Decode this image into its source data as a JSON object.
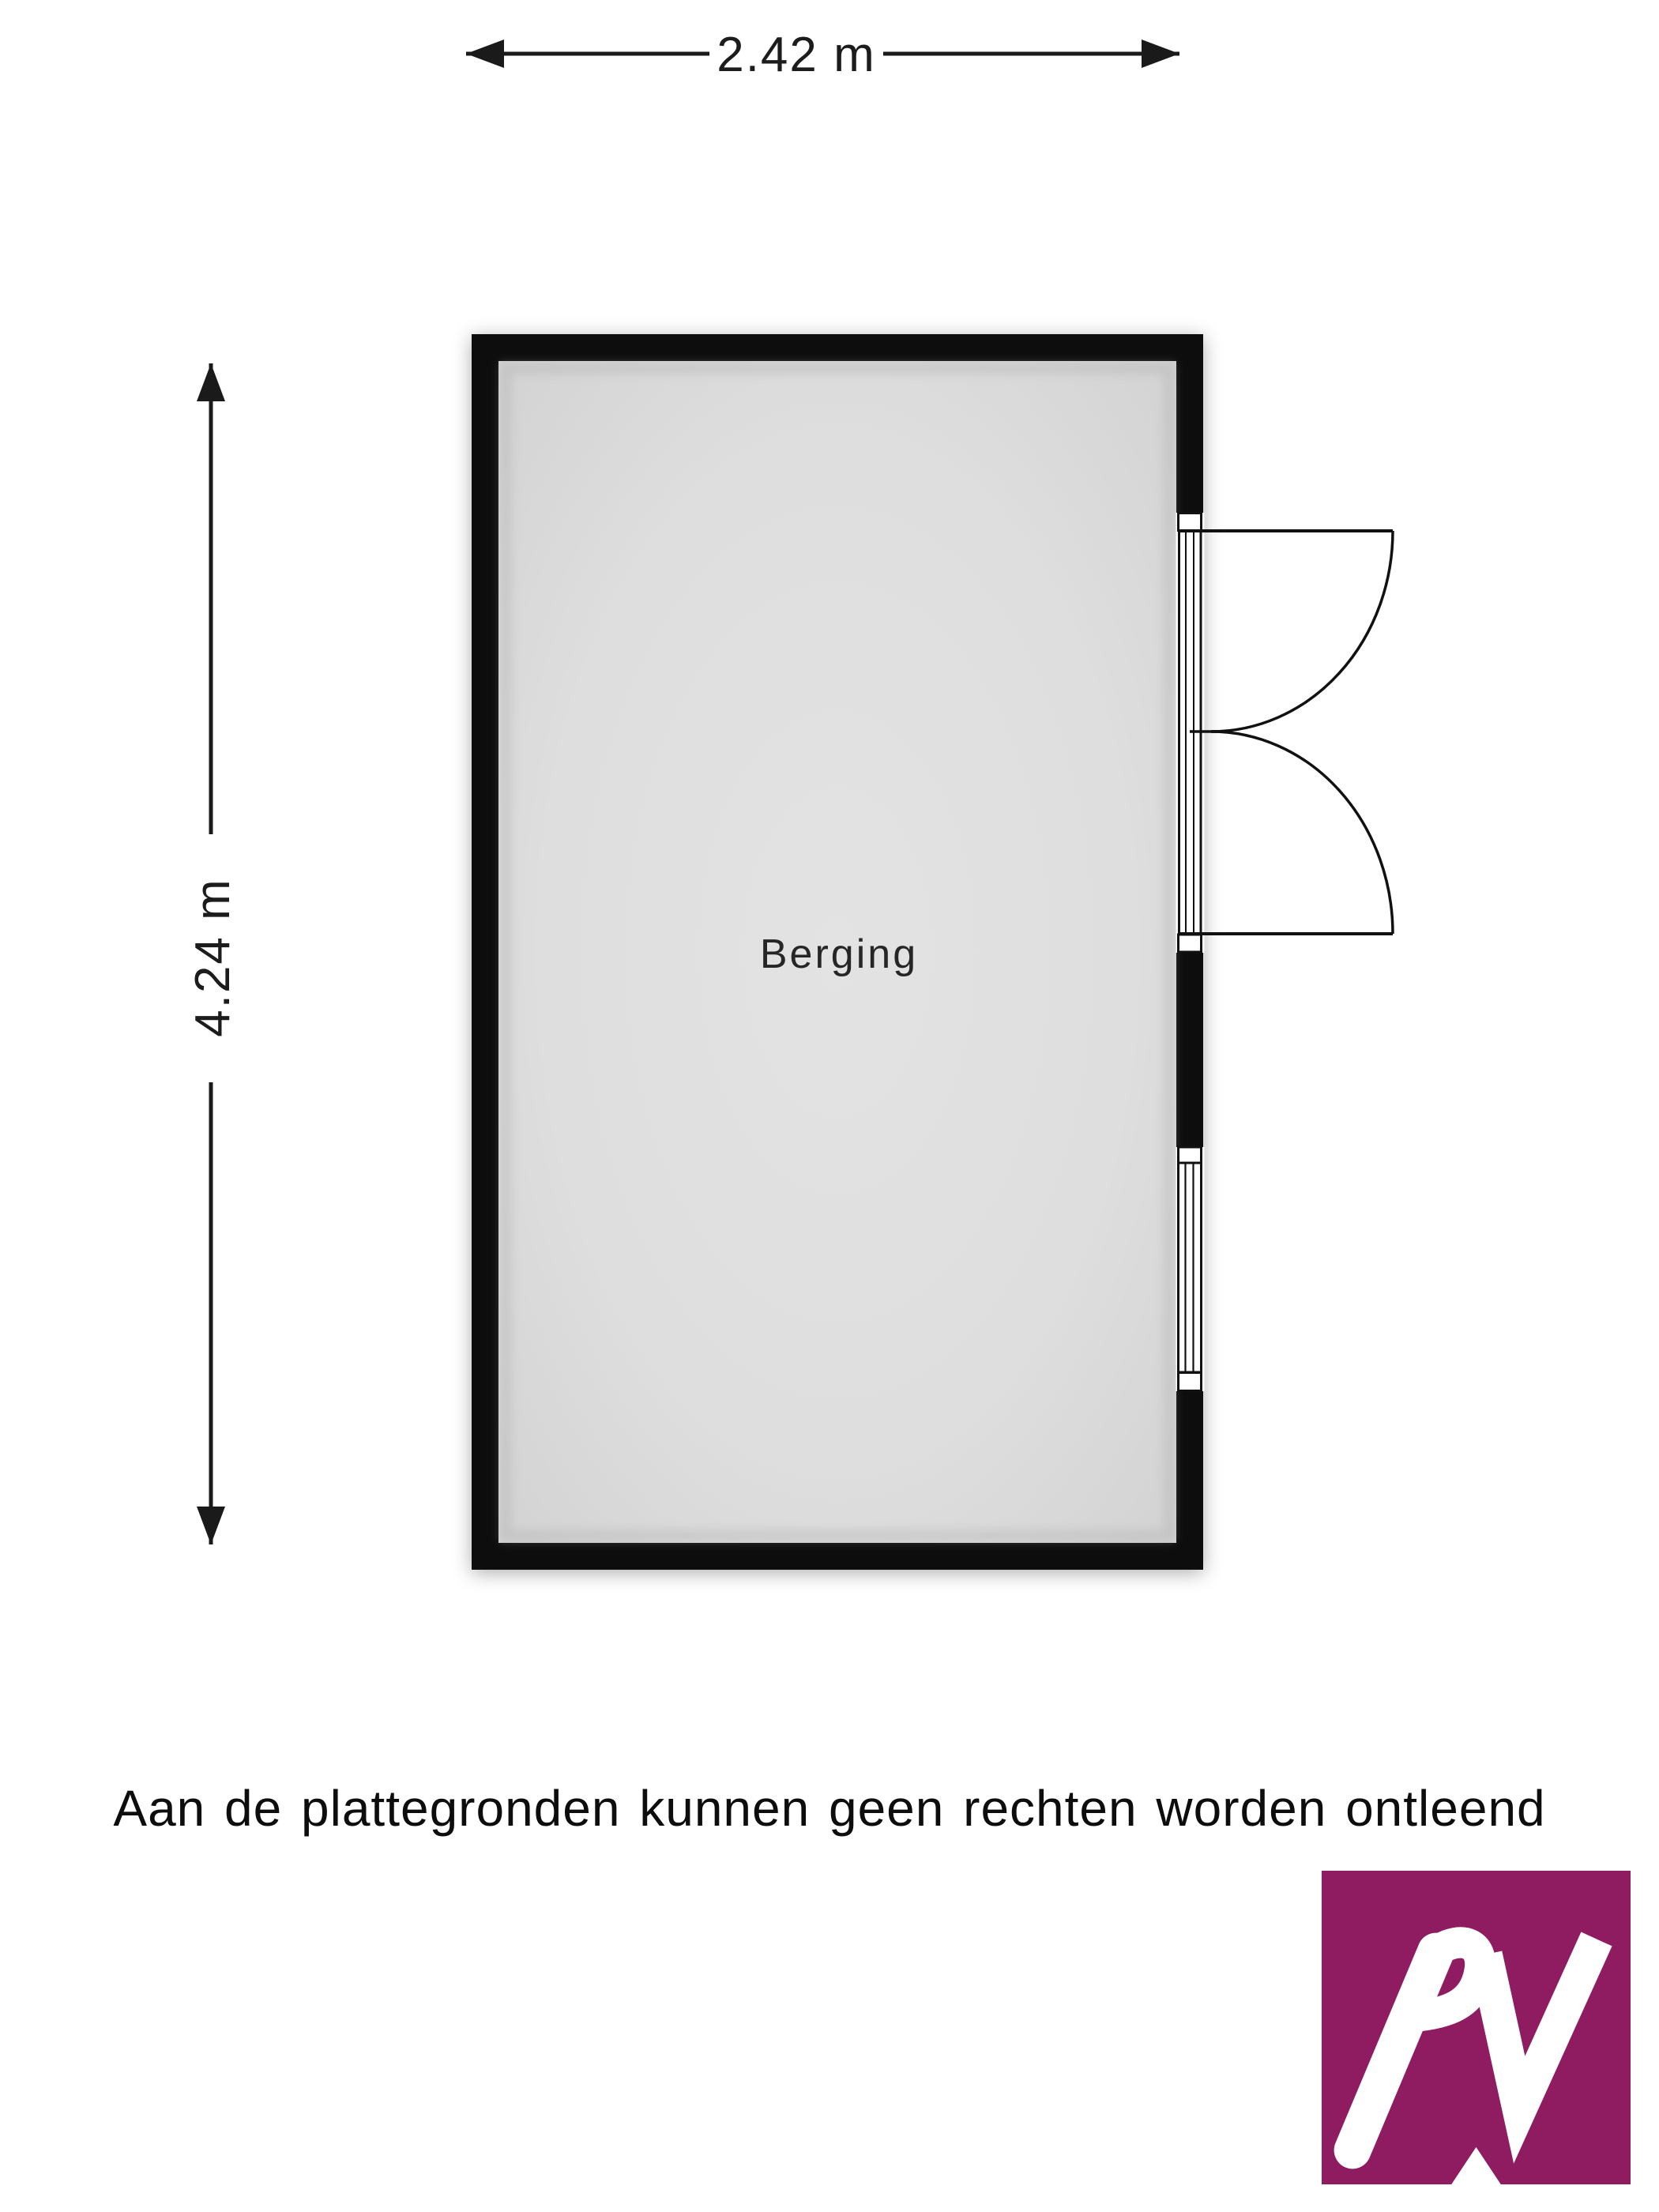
{
  "dimensions": {
    "width_label": "2.42 m",
    "height_label": "4.24 m"
  },
  "room": {
    "label": "Berging"
  },
  "disclaimer": "Aan de plattegronden kunnen geen rechten worden ontleend",
  "logo": {
    "monogram": "AV",
    "color": "#8f1c61"
  },
  "colors": {
    "wall": "#0b0b0b",
    "floor": "#dfdfdf",
    "line": "#1a1a1a",
    "background": "#ffffff"
  }
}
